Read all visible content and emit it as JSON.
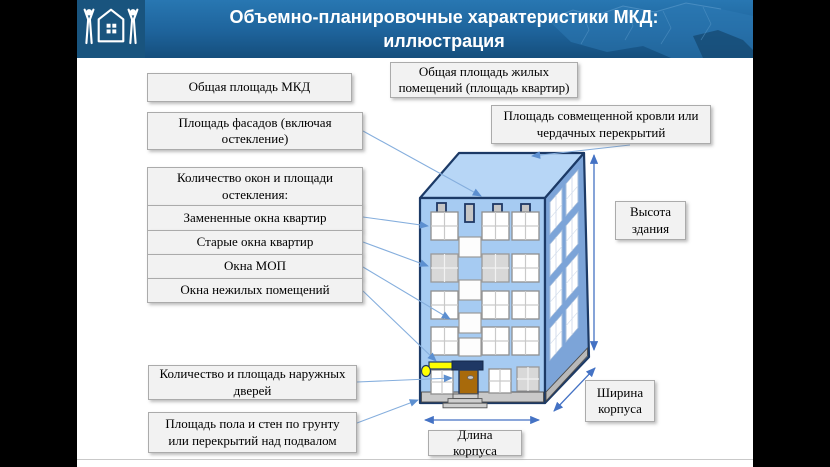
{
  "header": {
    "title_line1": "Объемно-планировочные характеристики МКД:",
    "title_line2": "иллюстрация"
  },
  "callouts": {
    "total_area": "Общая площадь МКД",
    "living_area": "Общая площадь жилых помещений (площадь квартир)",
    "facade_area": "Площадь фасадов (включая остекление)",
    "roof_area": "Площадь совмещенной кровли или чердачных перекрытий",
    "windows_header": "Количество окон и площади остекления:",
    "windows_replaced": "Замененные окна квартир",
    "windows_old": "Старые окна квартир",
    "windows_common": "Окна МОП",
    "windows_nonresidential": "Окна нежилых помещений",
    "building_height": "Высота здания",
    "entrance_doors": "Количество и площадь наружных дверей",
    "ground_floor": "Площадь пола и стен по грунту или перекрытий над подвалом",
    "body_width": "Ширина корпуса",
    "body_length": "Длина корпуса"
  },
  "icons": {
    "logo": "house-with-people-icon",
    "map": "russia-map-silhouette"
  },
  "colors": {
    "banner_top": "#2877B2",
    "banner_bottom": "#154E7C",
    "logo_bg": "#19547E",
    "box_bg": "#F2F2F2",
    "box_border": "#ABABAB",
    "building_front": "#A6CBF2",
    "building_roof": "#B7D6F6",
    "building_side": "#7CA4D8",
    "building_outline": "#1C3A66",
    "connector_line": "#6FA0D8",
    "dimension_line": "#4472C4",
    "accent_yellow": "#FFFF00",
    "door_brown": "#A86A0B"
  }
}
